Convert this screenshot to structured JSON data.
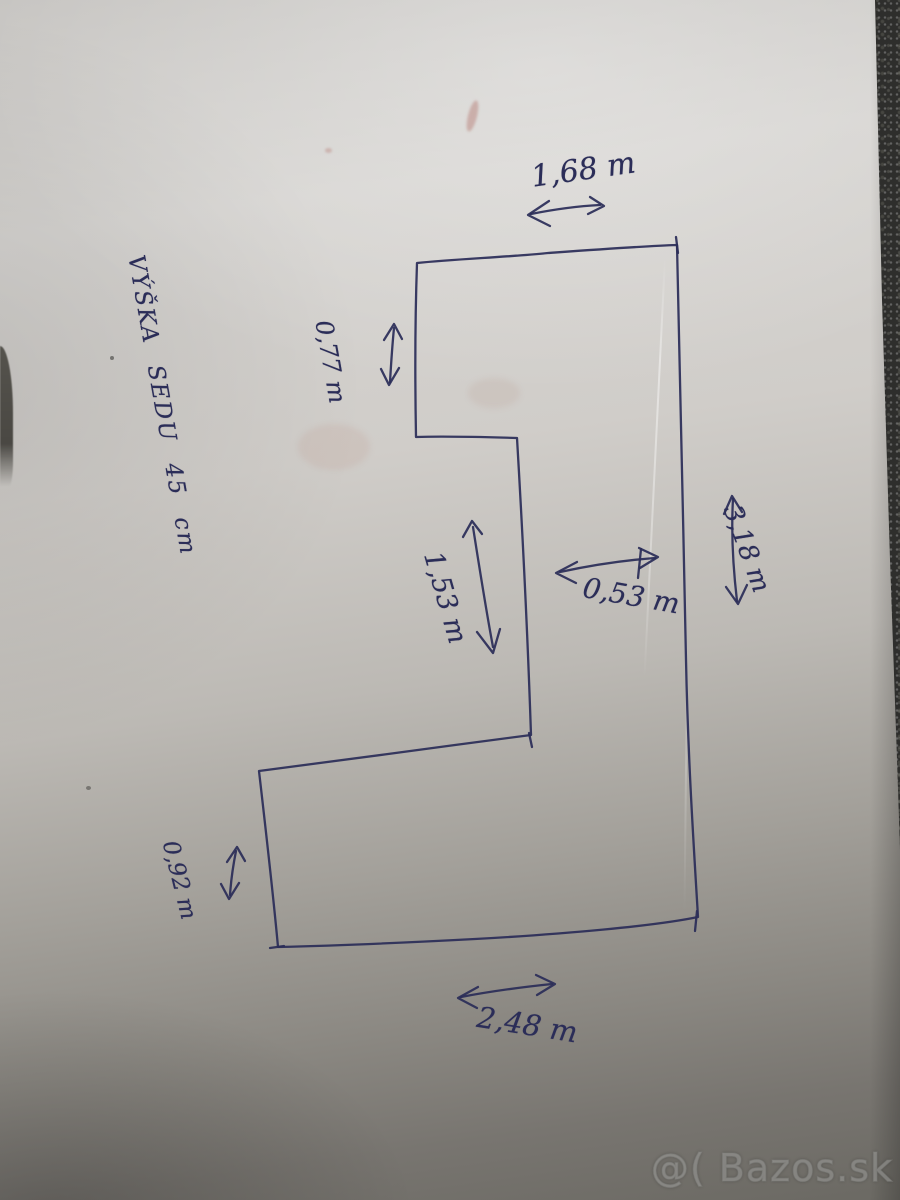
{
  "diagram": {
    "note": "VÝŠKA SEDU 45 cm",
    "measurements": {
      "top_width": "1,68 m",
      "upper_left_depth": "0,77 m",
      "middle_width": "1,53 m",
      "inner_depth": "0,53 m",
      "right_length": "3,18 m",
      "lower_left_depth": "0,92 m",
      "bottom_width": "2,48 m"
    }
  },
  "watermark": {
    "text": "@( Bazos.sk"
  },
  "colors": {
    "ink": "#2b2d58",
    "paper_light": "#d6d4d1",
    "paper_dark": "#6b6963",
    "background": "#2e2e2c"
  }
}
